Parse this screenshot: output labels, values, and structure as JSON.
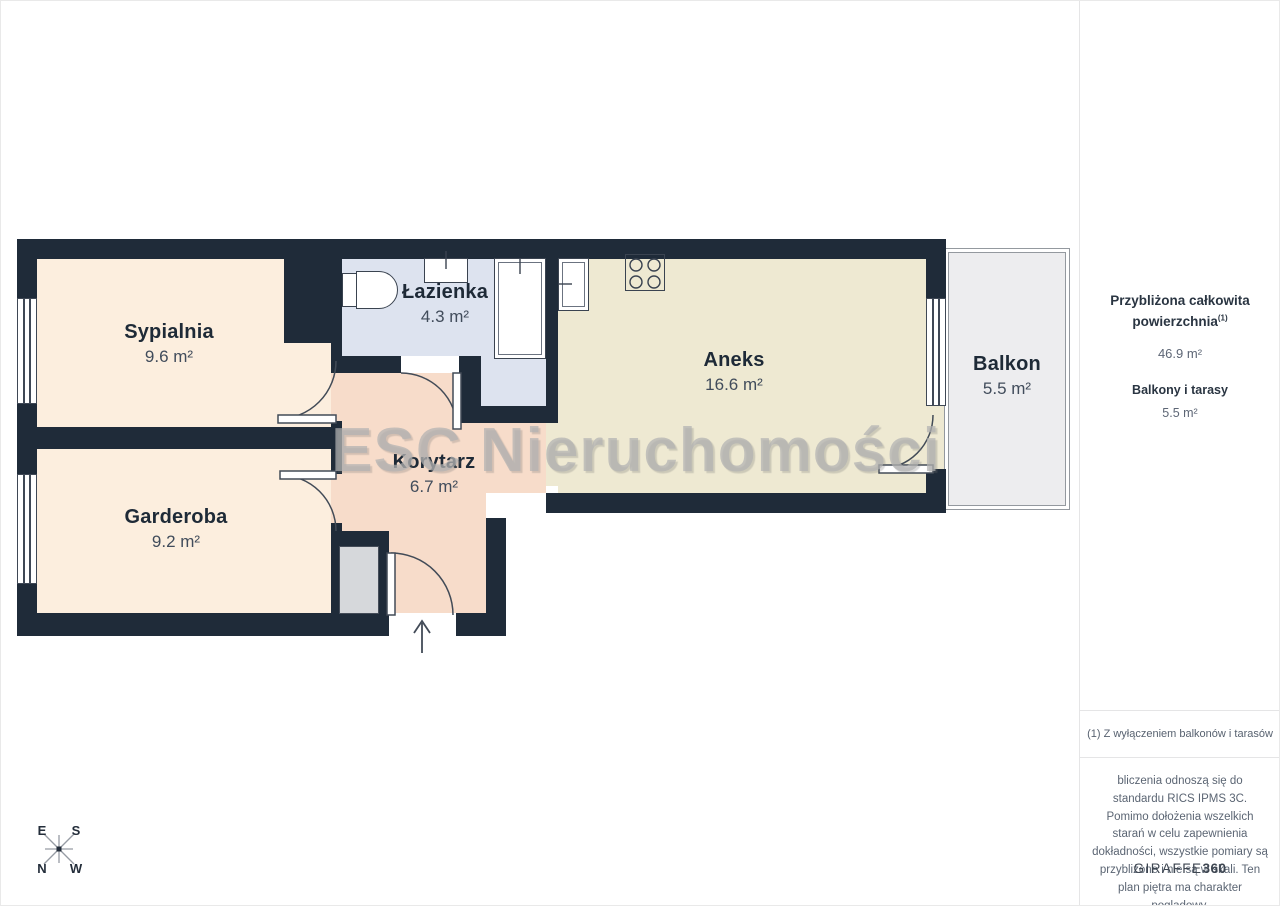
{
  "watermark": "ESC Nieruchomości",
  "rooms": [
    {
      "name": "Sypialnia",
      "area": "9.6 m²"
    },
    {
      "name": "Łazienka",
      "area": "4.3 m²"
    },
    {
      "name": "Aneks",
      "area": "16.6 m²"
    },
    {
      "name": "Balkon",
      "area": "5.5 m²"
    },
    {
      "name": "Korytarz",
      "area": "6.7 m²"
    },
    {
      "name": "Garderoba",
      "area": "9.2 m²"
    }
  ],
  "compass": {
    "top_left": "E",
    "top_right": "S",
    "bottom_left": "N",
    "bottom_right": "W"
  },
  "sidebar": {
    "total_label_line1": "Przybliżona całkowita",
    "total_label_line2": "powierzchnia",
    "total_sup": "(1)",
    "total_value": "46.9 m²",
    "balconies_label": "Balkony i tarasy",
    "balconies_value": "5.5 m²",
    "footnote": "(1) Z wyłączeniem balkonów i tarasów",
    "disclaimer": "bliczenia odnoszą się do standardu RICS IPMS 3C. Pomimo dołożenia wszelkich starań w celu zapewnienia dokładności, wszystkie pomiary są przybliżone i nie są w skali. Ten plan piętra ma charakter poglądowy.",
    "brand_name": "GIRAFFE",
    "brand_number": "360"
  },
  "colors": {
    "wall": "#1f2b39",
    "bedroom_floor": "#fceede",
    "corridor_floor": "#f7dcca",
    "bathroom_floor": "#dde3ef",
    "kitchen_floor": "#eee9d2",
    "balcony_floor": "#ededef"
  }
}
